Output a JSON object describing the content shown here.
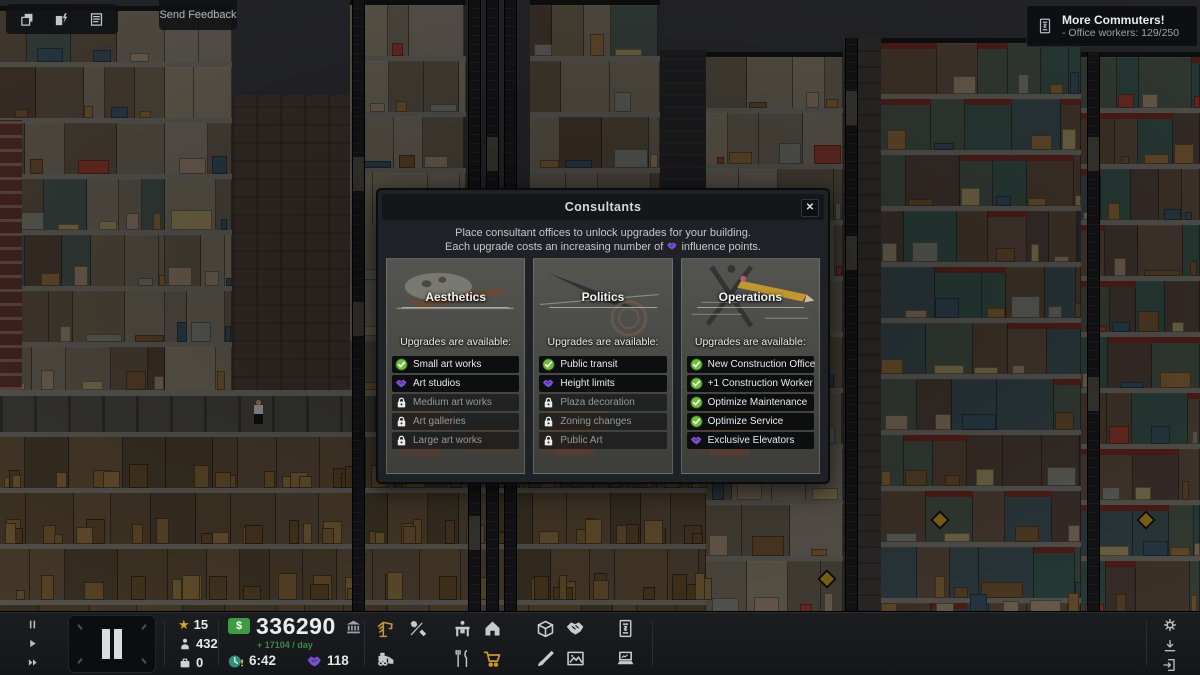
{
  "top_left": {
    "buttons": [
      {
        "icon": "layers-icon"
      },
      {
        "icon": "utilities-icon"
      },
      {
        "icon": "ledger-icon"
      }
    ],
    "feedback_label": "Send Feedback"
  },
  "notification": {
    "icon": "contract-icon",
    "title": "More Commuters!",
    "detail": "-  Office workers: 129/250"
  },
  "modal": {
    "title": "Consultants",
    "close_label": "✕",
    "desc_line1": "Place consultant offices to unlock upgrades for your building.",
    "desc_line2_pre": "Each upgrade costs an increasing number of",
    "desc_line2_post": "influence points.",
    "cards": [
      {
        "title": "Aesthetics",
        "subtitle": "Upgrades are available:",
        "art": "aesthetics",
        "items": [
          {
            "label": "Small art works",
            "status": "unlocked"
          },
          {
            "label": "Art studios",
            "status": "influence"
          },
          {
            "label": "Medium art works",
            "status": "locked"
          },
          {
            "label": "Art galleries",
            "status": "locked"
          },
          {
            "label": "Large art works",
            "status": "locked"
          }
        ]
      },
      {
        "title": "Politics",
        "subtitle": "Upgrades are available:",
        "art": "politics",
        "items": [
          {
            "label": "Public transit",
            "status": "unlocked"
          },
          {
            "label": "Height limits",
            "status": "influence"
          },
          {
            "label": "Plaza decoration",
            "status": "locked"
          },
          {
            "label": "Zoning changes",
            "status": "locked"
          },
          {
            "label": "Public Art",
            "status": "locked"
          }
        ]
      },
      {
        "title": "Operations",
        "subtitle": "Upgrades are available:",
        "art": "operations",
        "items": [
          {
            "label": "New Construction Office",
            "status": "unlocked"
          },
          {
            "label": "+1 Construction Worker",
            "status": "unlocked"
          },
          {
            "label": "Optimize Maintenance",
            "status": "unlocked"
          },
          {
            "label": "Optimize Service",
            "status": "unlocked"
          },
          {
            "label": "Exclusive Elevators",
            "status": "influence"
          }
        ]
      }
    ]
  },
  "toolbar": {
    "speed_controls": [
      {
        "icon": "pause-icon"
      },
      {
        "icon": "play-icon"
      },
      {
        "icon": "fast-forward-icon"
      }
    ],
    "stats": [
      {
        "icon": "star-icon",
        "value": "15"
      },
      {
        "icon": "person-icon",
        "value": "432"
      },
      {
        "icon": "suitcase-icon",
        "value": "0"
      }
    ],
    "money": {
      "badge": "$",
      "balance": "336290",
      "bank_icon": "bank-icon",
      "income": "+ 17104 / day",
      "clock_icon": "clock-icon",
      "time": "6:42",
      "influence_icon": "influence-icon",
      "influence": "118"
    },
    "build_row1": [
      {
        "icon": "crane",
        "gold": true
      },
      {
        "icon": "tools",
        "gold": false
      },
      {
        "icon": "desk",
        "gold": false
      },
      {
        "icon": "home",
        "gold": false
      },
      {
        "icon": "box",
        "gold": false
      },
      {
        "icon": "handshake",
        "gold": false
      },
      {
        "icon": "contract",
        "gold": false
      }
    ],
    "build_row2": [
      {
        "icon": "bulldozer",
        "gold": false
      },
      {
        "icon": "food",
        "gold": false
      },
      {
        "icon": "cart",
        "gold": true
      },
      {
        "icon": "brush",
        "gold": false
      },
      {
        "icon": "frame",
        "gold": false
      },
      {
        "icon": "laptop",
        "gold": false
      }
    ],
    "system_icons": [
      "gear",
      "download",
      "exit"
    ]
  },
  "colors": {
    "accent_gold": "#c9962e",
    "check_green": "#6fbf3a",
    "influence_purple": "#7a4fd0",
    "money_green": "#3f9b43",
    "income_green": "#3a8a40"
  }
}
